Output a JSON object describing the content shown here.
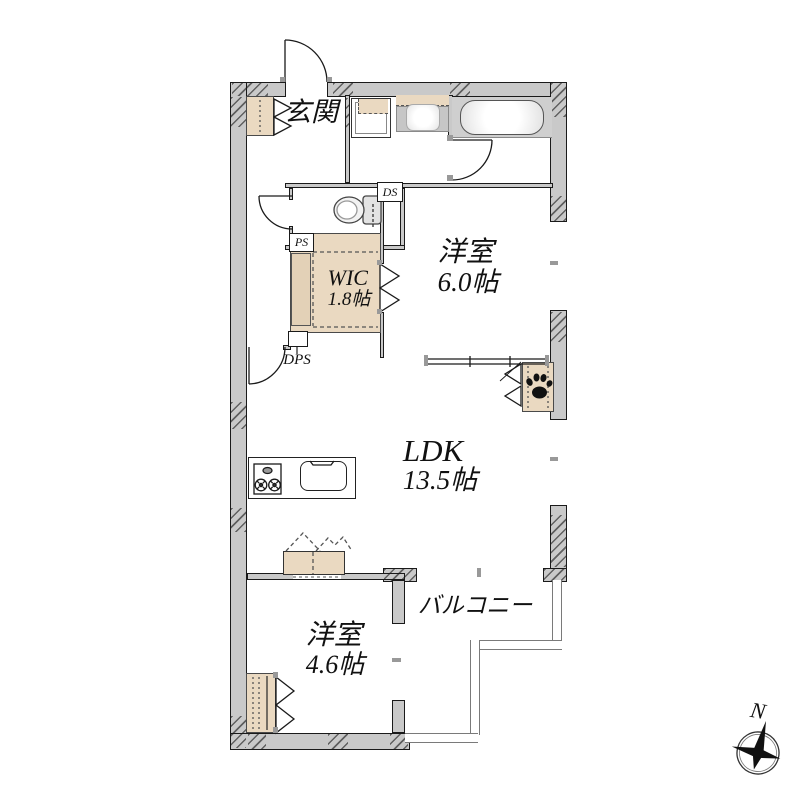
{
  "rooms": {
    "entrance": {
      "label": "玄関"
    },
    "bedroom1": {
      "name": "洋室",
      "size": "6.0帖"
    },
    "wic": {
      "name": "WIC",
      "size": "1.8帖"
    },
    "ldk": {
      "name": "LDK",
      "size": "13.5帖"
    },
    "bedroom2": {
      "name": "洋室",
      "size": "4.6帖"
    },
    "balcony": {
      "label": "バルコニー"
    }
  },
  "shafts": {
    "ds": "DS",
    "ps": "PS",
    "dps": "DPS"
  },
  "compass": {
    "north": "N"
  },
  "icons": {
    "pet": "paw-print-icon",
    "compass": "compass-rose-icon"
  },
  "colors": {
    "wall": "#c9c9c9",
    "storage_fill": "#ead9c1",
    "line": "#1a1a1a",
    "fixture_gray": "#cfcfcf",
    "background": "#ffffff"
  }
}
